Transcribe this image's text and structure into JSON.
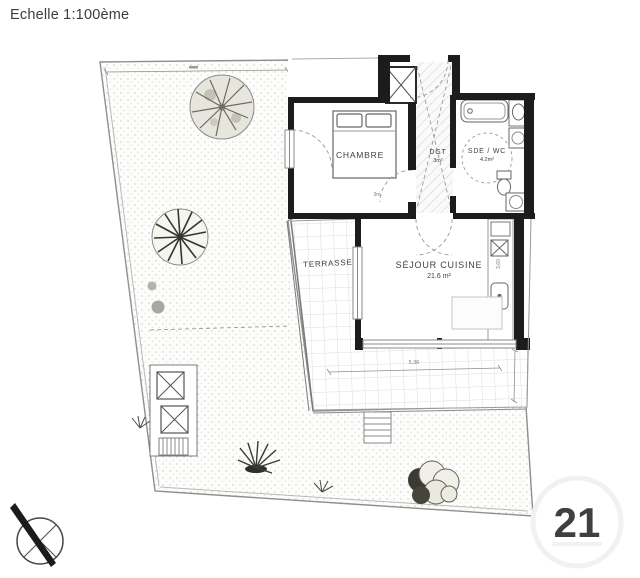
{
  "title": "Echelle 1:100ème",
  "watermark": "21",
  "plan": {
    "rooms": {
      "chambre": {
        "label": "CHAMBRE"
      },
      "dgt": {
        "label": "DGT",
        "area": "3m²"
      },
      "sde_wc": {
        "label": "SDE / WC",
        "area": "4.2m²"
      },
      "sejour": {
        "label": "SÉJOUR CUISINE",
        "area": "21.6 m²"
      },
      "terrasse": {
        "label": "TERRASSE"
      }
    },
    "dimensions": {
      "terrasse_width": "5,36",
      "chambre_width": "3m",
      "sejour_depth": "3,60"
    }
  },
  "colors": {
    "wall": "#1c1c1c",
    "thin_line": "#8a8a8a",
    "label_text": "#3f3f3f",
    "stipple_dot": "#c6c6c2",
    "tile_line": "#dcdcdc",
    "watermark": "#f2f2f2"
  }
}
